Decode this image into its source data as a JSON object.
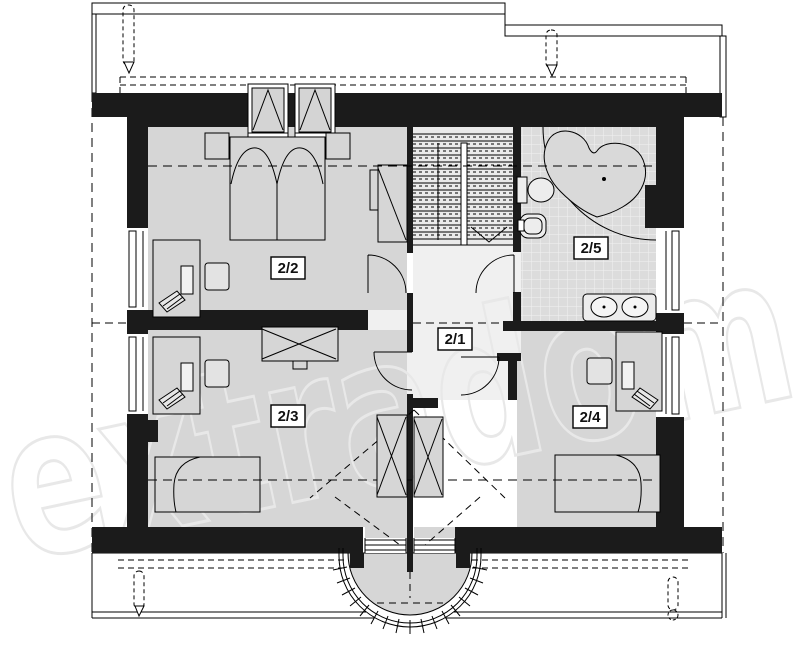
{
  "plan_title": "attic floor plan",
  "watermark": {
    "text": "extradom",
    "color": "#e8e8e8"
  },
  "rooms": [
    {
      "id": "2/1",
      "name": "hall-landing"
    },
    {
      "id": "2/2",
      "name": "bedroom-left-top"
    },
    {
      "id": "2/3",
      "name": "bedroom-left-bottom"
    },
    {
      "id": "2/4",
      "name": "bedroom-right-bottom"
    },
    {
      "id": "2/5",
      "name": "bathroom"
    }
  ],
  "fixture_icons": [
    "double-bed-icon",
    "nightstand-icon",
    "desk-icon",
    "office-chair-icon",
    "side-table-icon",
    "wardrobe-icon",
    "single-bed-icon",
    "corner-bathtub-icon",
    "toilet-icon",
    "bidet-icon",
    "double-washbasin-icon",
    "staircase-icon",
    "roof-window-icon",
    "window-icon",
    "door-arc-icon",
    "balcony-railing-icon",
    "roof-vent-icon"
  ],
  "palette": {
    "wall": "#1b1b1b",
    "line": "#000000",
    "room_floor": "#d6d6d6",
    "hall_floor": "#f0f0f0",
    "stair_floor": "#eaeaea",
    "tile_floor": "#dcdcdc",
    "tile_line": "#f2f2f2",
    "fixture_fill": "#ededed",
    "watermark": "#e8e8e8"
  }
}
